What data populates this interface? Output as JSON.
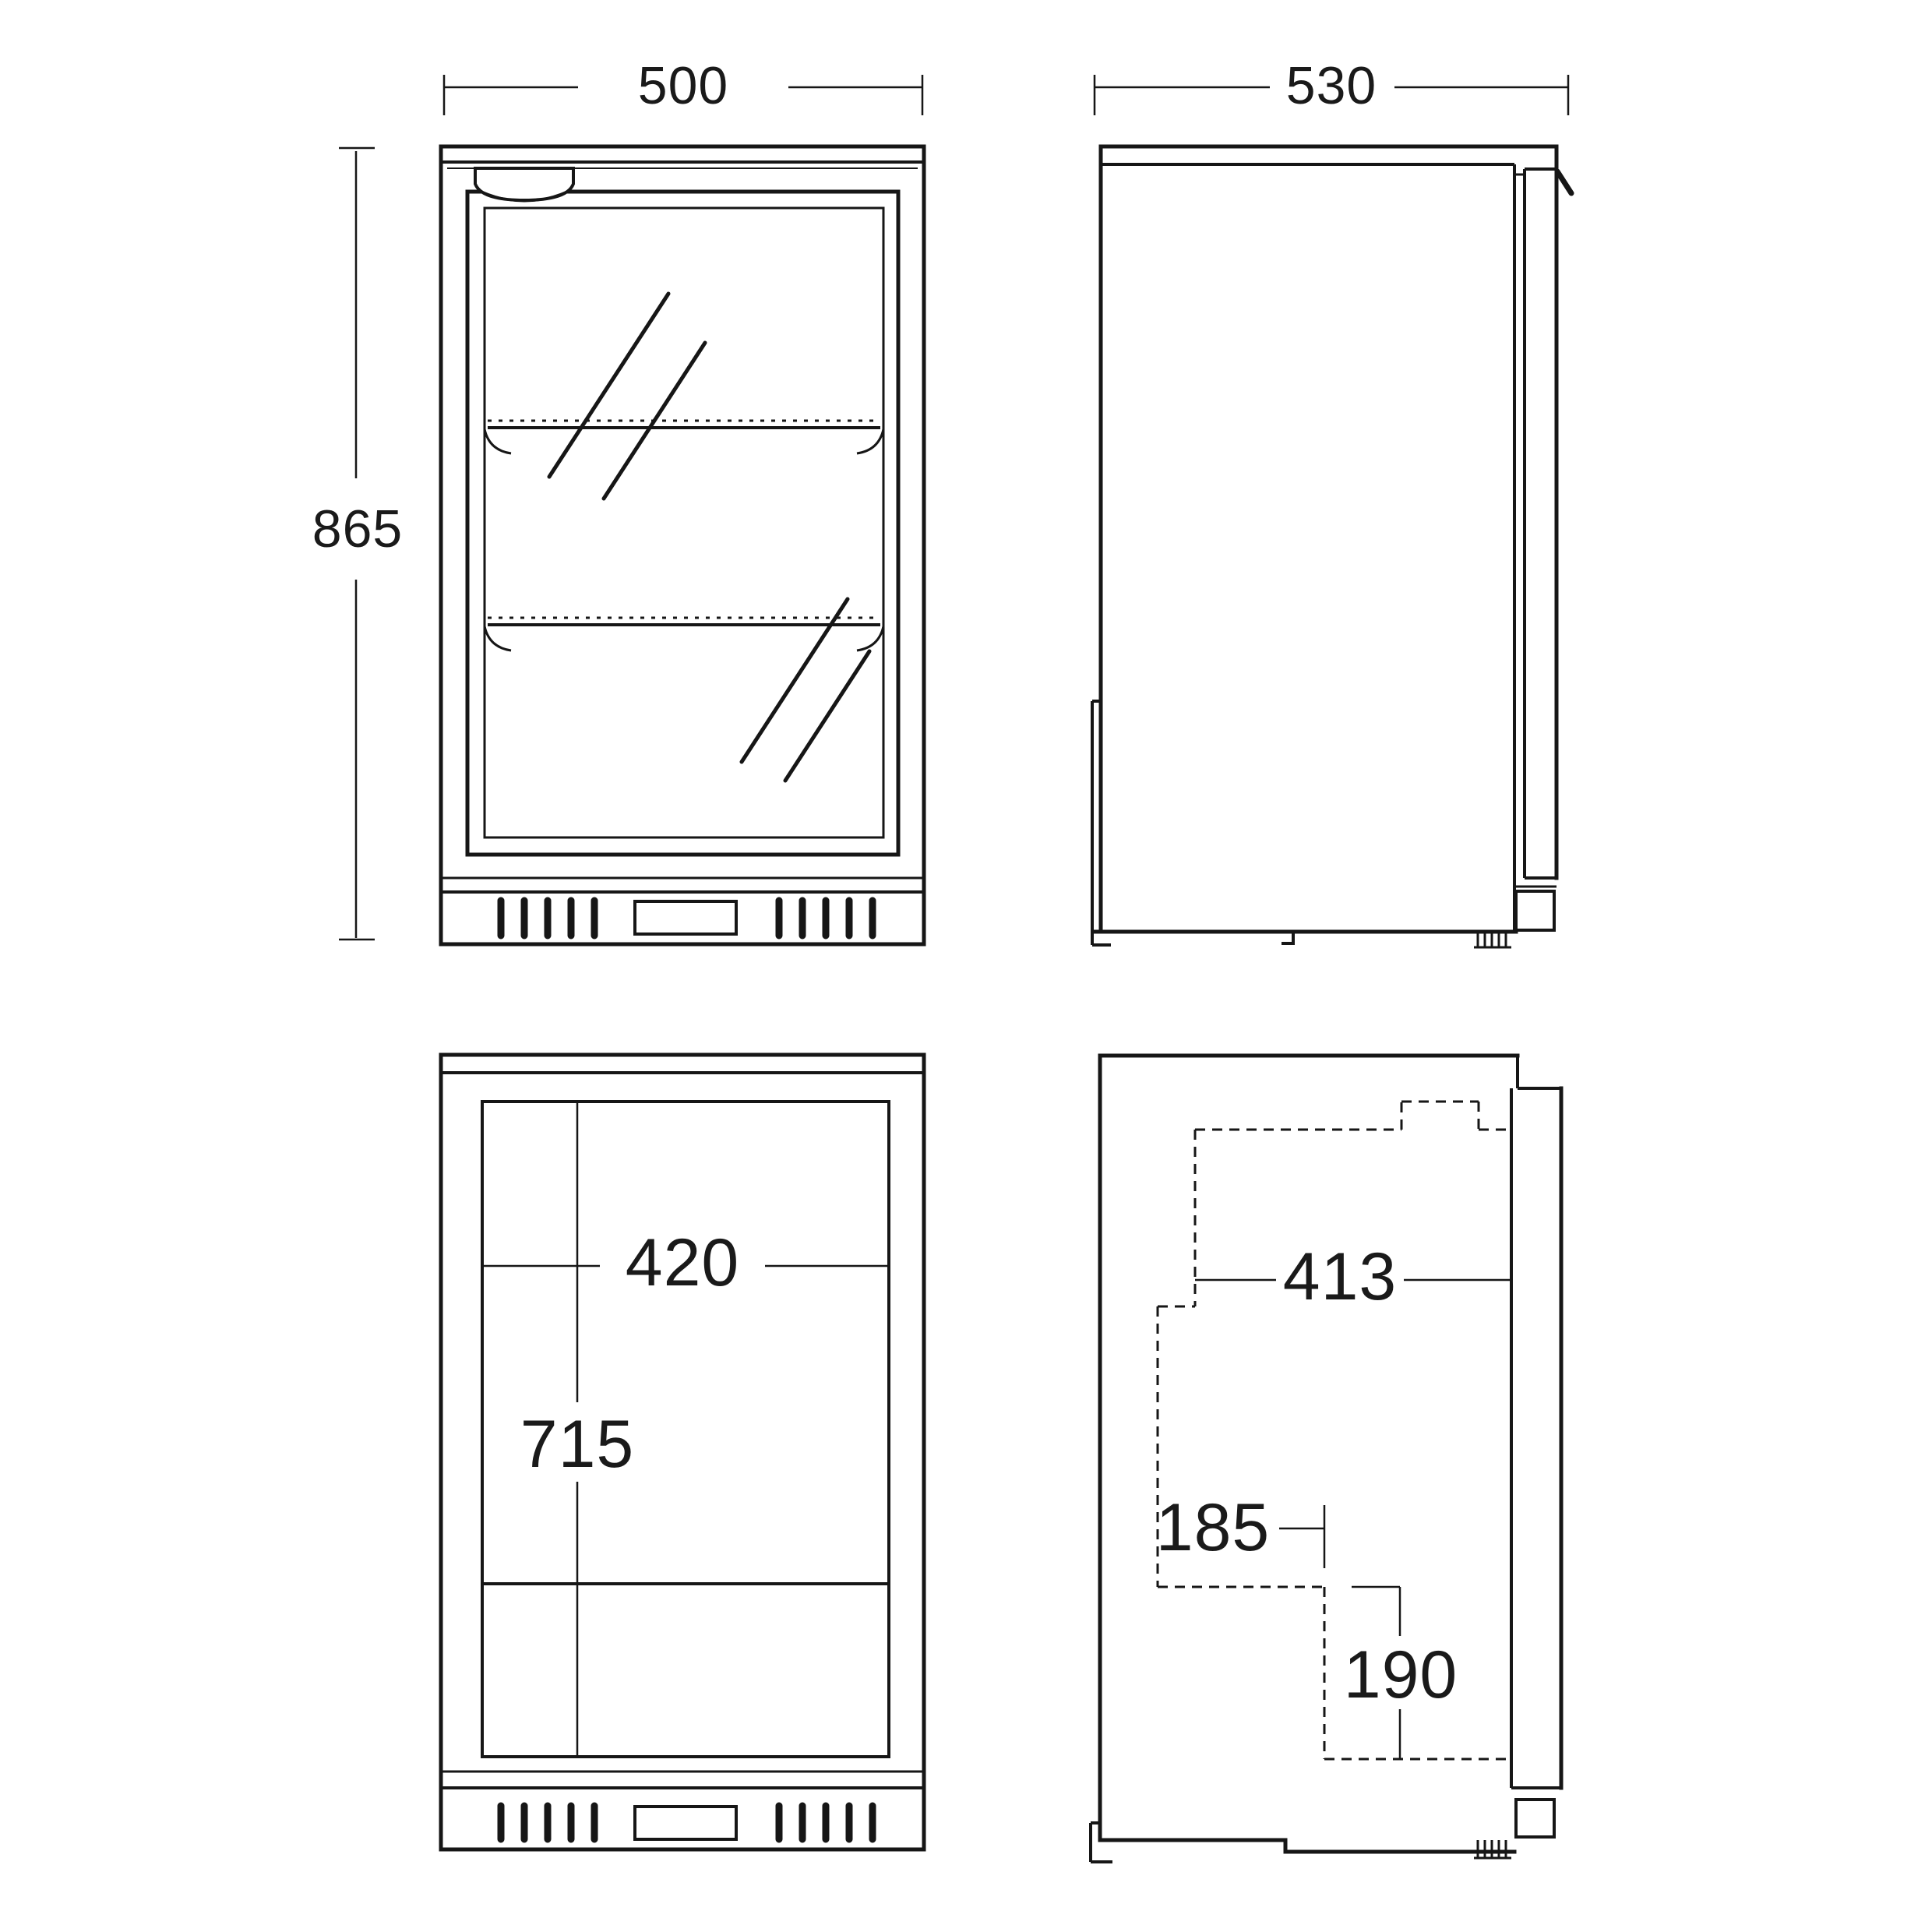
{
  "diagram": {
    "title": "bar-fridge-dimension-drawing",
    "background_color": "#ffffff",
    "line_color": "#161616",
    "views": {
      "front_exterior": {
        "width": {
          "label": "500"
        },
        "height": {
          "label": "865"
        }
      },
      "side_exterior": {
        "depth": {
          "label": "530"
        }
      },
      "front_interior": {
        "inner_width": {
          "label": "420"
        },
        "inner_height": {
          "label": "715"
        }
      },
      "side_interior": {
        "inner_depth": {
          "label": "413"
        },
        "step_depth": {
          "label": "185"
        },
        "step_height": {
          "label": "190"
        }
      }
    }
  }
}
